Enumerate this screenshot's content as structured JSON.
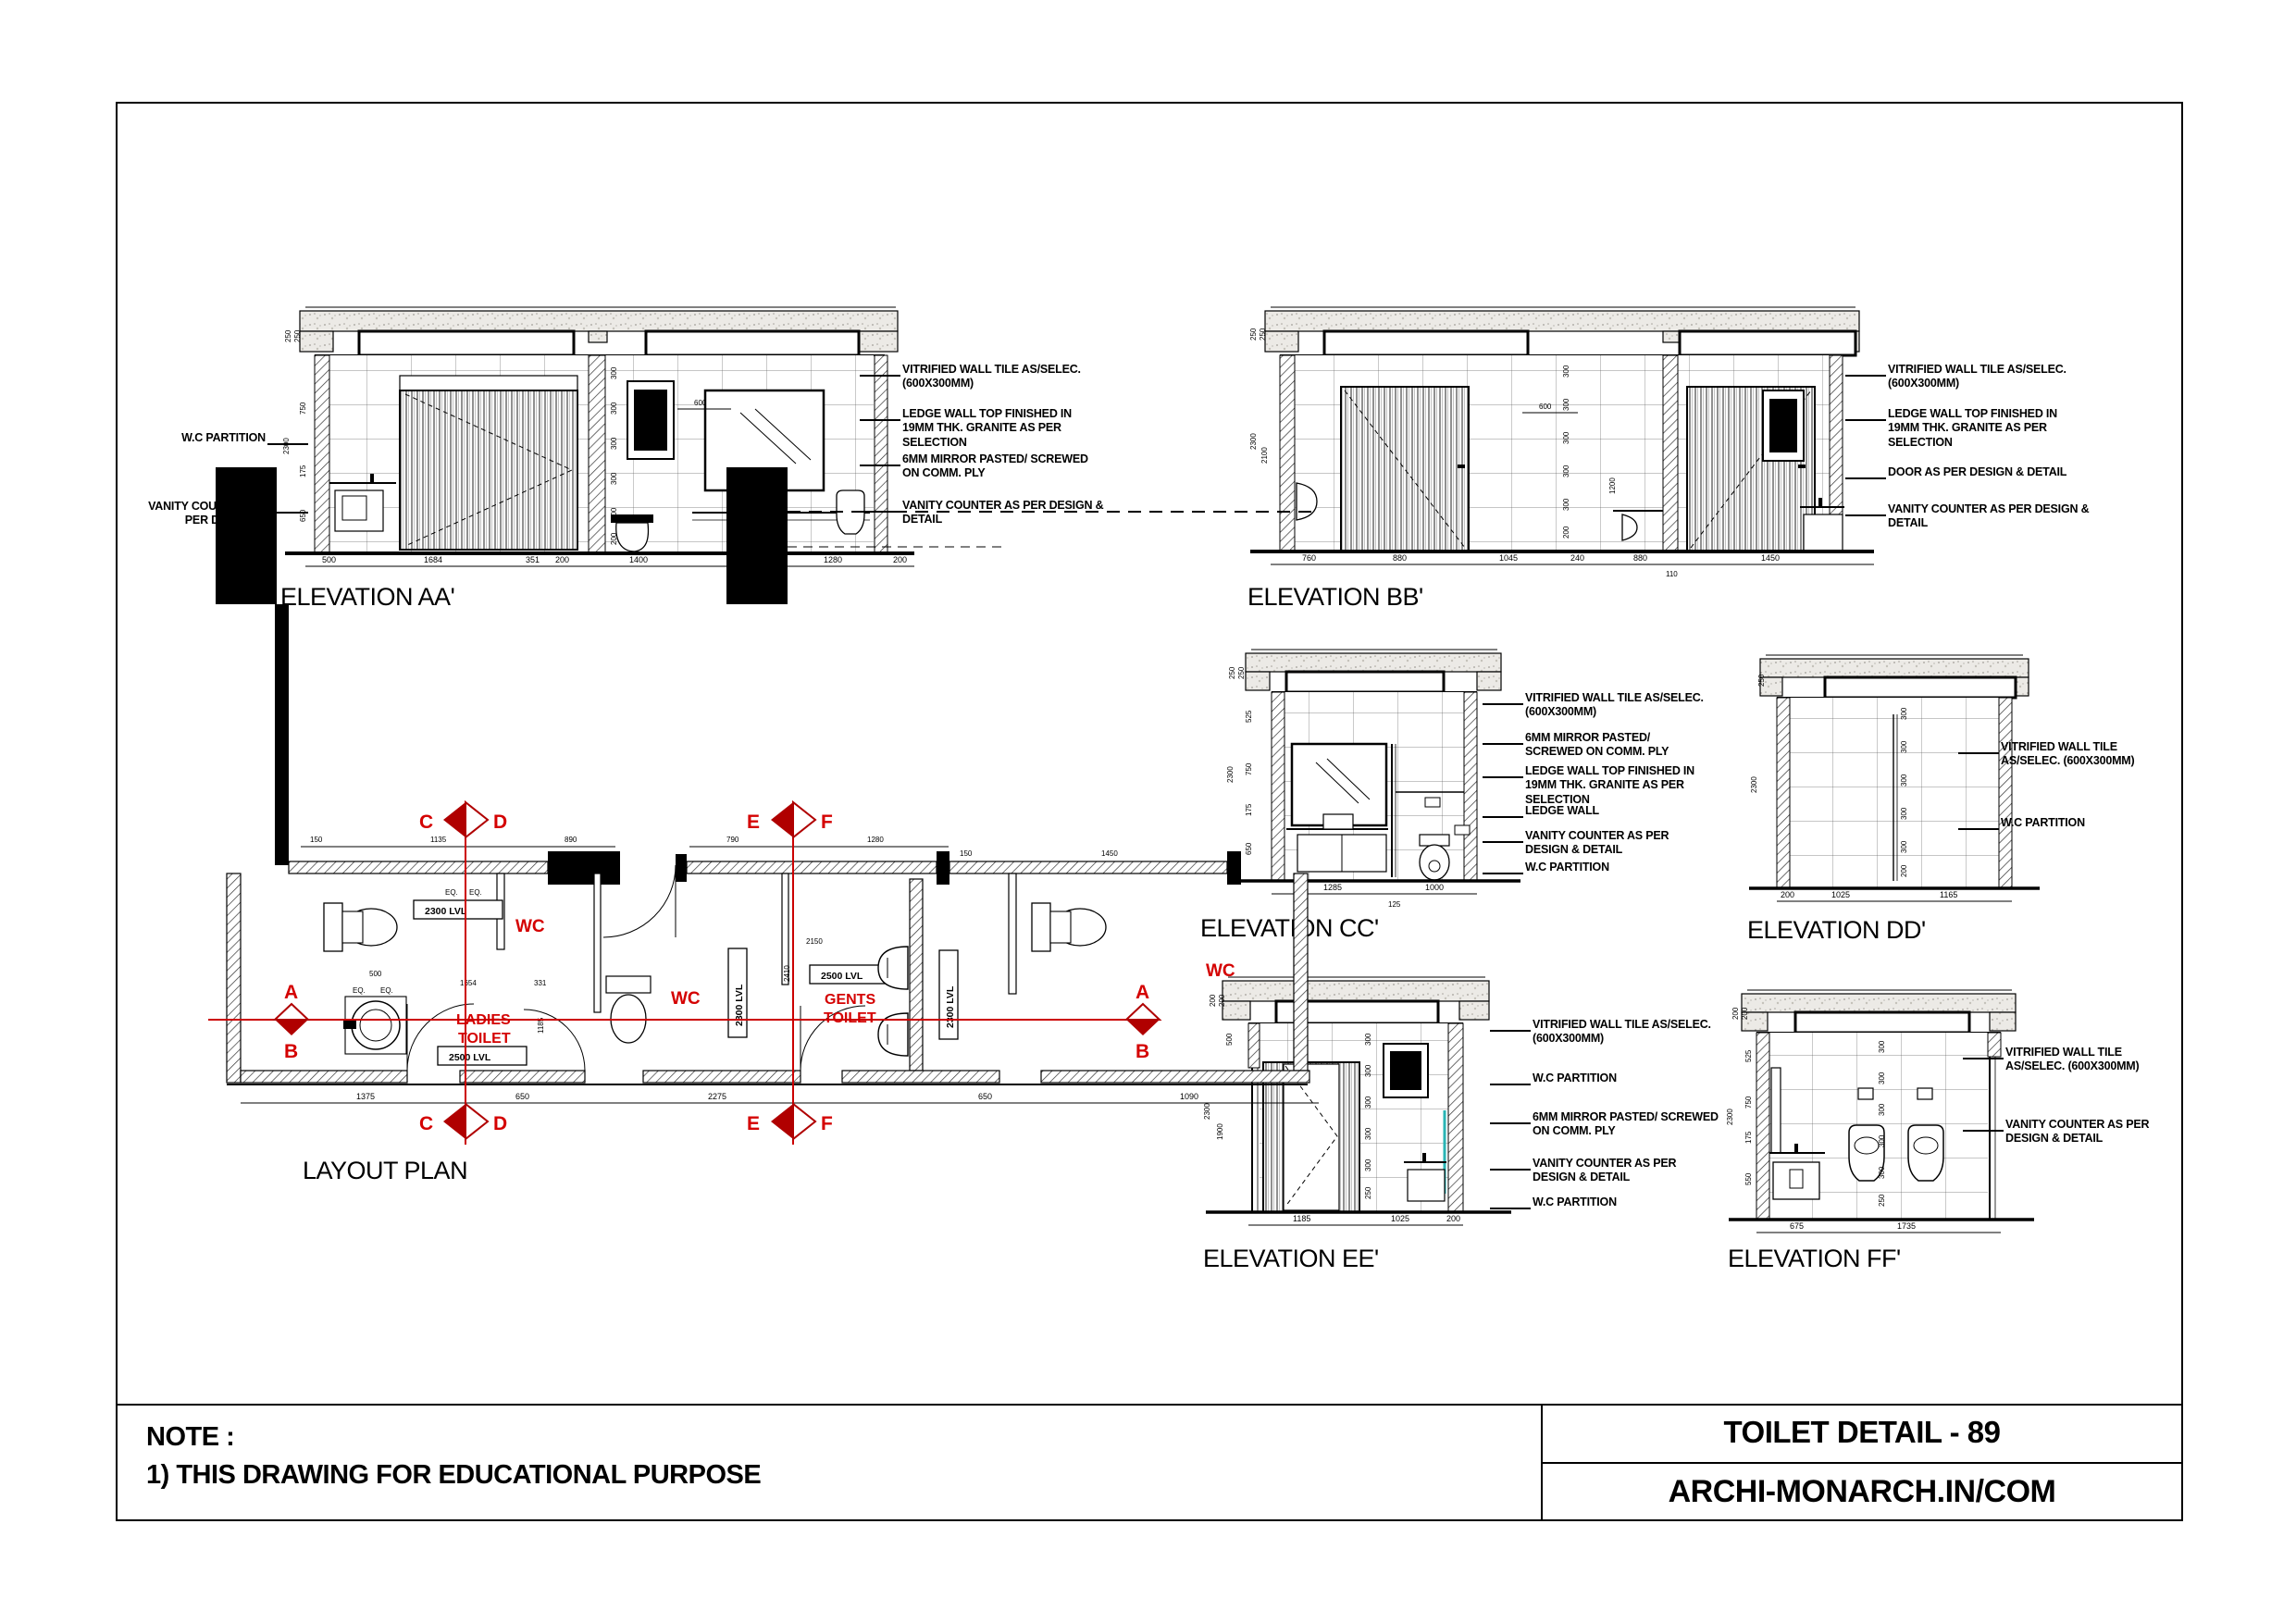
{
  "sheet": {
    "note_heading": "NOTE :",
    "note_item": "1) THIS DRAWING FOR EDUCATIONAL PURPOSE",
    "title_block": {
      "drawing_title": "TOILET DETAIL - 89",
      "website": "ARCHI-MONARCH.IN/COM"
    }
  },
  "colors": {
    "red_label": "#d40000",
    "marker_red": "#b00000",
    "line": "#000000",
    "slab": "#eceae6"
  },
  "common": {
    "t300": "300",
    "t200": "200",
    "t250": "250",
    "t2300": "2300",
    "eq": "EQ.",
    "t600": "600"
  },
  "elev_aa": {
    "title": "ELEVATION AA'",
    "notes_left": [
      "W.C PARTITION",
      "VANITY COUNTER AS PER DESIGN & DETAIL"
    ],
    "notes_right": [
      "VITRIFIED WALL TILE AS/SELEC. (600X300MM)",
      "LEDGE WALL TOP FINISHED IN 19MM THK. GRANITE AS PER SELECTION",
      "6MM MIRROR PASTED/ SCREWED ON COMM. PLY",
      "VANITY COUNTER AS PER DESIGN & DETAIL"
    ],
    "dims_bottom": [
      "500",
      "1684",
      "351",
      "200",
      "1400",
      "700",
      "1280",
      "200"
    ],
    "dims_left": [
      "250",
      "250",
      "750",
      "175",
      "650",
      "2300"
    ]
  },
  "elev_bb": {
    "title": "ELEVATION BB'",
    "notes_right": [
      "VITRIFIED WALL TILE AS/SELEC. (600X300MM)",
      "LEDGE WALL TOP FINISHED IN 19MM THK. GRANITE AS PER SELECTION",
      "DOOR AS PER DESIGN & DETAIL",
      "VANITY COUNTER AS PER DESIGN & DETAIL"
    ],
    "dims_bottom": [
      "760",
      "880",
      "1045",
      "240",
      "880",
      "1450"
    ],
    "dims_left": [
      "250",
      "250",
      "2300",
      "2100"
    ],
    "dims_extra": [
      "600",
      "1200",
      "110"
    ]
  },
  "elev_cc": {
    "title": "ELEVATION CC'",
    "notes_right": [
      "VITRIFIED WALL TILE AS/SELEC. (600X300MM)",
      "6MM MIRROR PASTED/ SCREWED ON COMM. PLY",
      "LEDGE WALL TOP FINISHED IN 19MM THK. GRANITE AS PER SELECTION",
      "LEDGE WALL",
      "VANITY COUNTER AS PER DESIGN & DETAIL",
      "W.C PARTITION"
    ],
    "dims_bottom": [
      "1285",
      "125",
      "1000"
    ],
    "dims_left": [
      "250",
      "250",
      "525",
      "750",
      "175",
      "650",
      "2300"
    ]
  },
  "elev_dd": {
    "title": "ELEVATION DD'",
    "notes_right": [
      "VITRIFIED WALL TILE AS/SELEC. (600X300MM)",
      "W.C PARTITION"
    ],
    "dims_bottom": [
      "200",
      "1025",
      "1165"
    ],
    "dims_left": [
      "250",
      "2300"
    ]
  },
  "elev_ee": {
    "title": "ELEVATION EE'",
    "notes_right": [
      "VITRIFIED WALL TILE AS/SELEC. (600X300MM)",
      "W.C PARTITION",
      "6MM MIRROR PASTED/ SCREWED ON COMM. PLY",
      "VANITY COUNTER AS PER DESIGN & DETAIL",
      "W.C PARTITION"
    ],
    "dims_bottom": [
      "1185",
      "1025",
      "200"
    ],
    "dims_left": [
      "200",
      "200",
      "500",
      "2300",
      "1900"
    ]
  },
  "elev_ff": {
    "title": "ELEVATION FF'",
    "notes_right": [
      "VITRIFIED WALL TILE AS/SELEC. (600X300MM)",
      "VANITY COUNTER AS PER DESIGN & DETAIL"
    ],
    "dims_bottom": [
      "675",
      "1735"
    ],
    "dims_left": [
      "200",
      "200",
      "525",
      "750",
      "175",
      "550",
      "2300"
    ]
  },
  "plan": {
    "title": "LAYOUT PLAN",
    "labels": {
      "wc1": "WC",
      "wc2": "WC",
      "wc3": "WC",
      "ladies1": "LADIES",
      "ladies2": "TOILET",
      "gents1": "GENTS",
      "gents2": "TOILET",
      "lvl2300": "2300 LVL",
      "lvl2500": "2500 LVL"
    },
    "sections": {
      "a": "A",
      "b": "B",
      "c": "C",
      "d": "D",
      "e": "E",
      "f": "F"
    },
    "dims_top": [
      "150",
      "1135",
      "890",
      "790",
      "1280"
    ],
    "dims_bottom": [
      "1375",
      "650",
      "2275",
      "650",
      "1090"
    ],
    "dims_right": [
      "150",
      "1450"
    ],
    "dims_inner": [
      "1654",
      "331",
      "500",
      "2150",
      "2410",
      "1185"
    ]
  }
}
